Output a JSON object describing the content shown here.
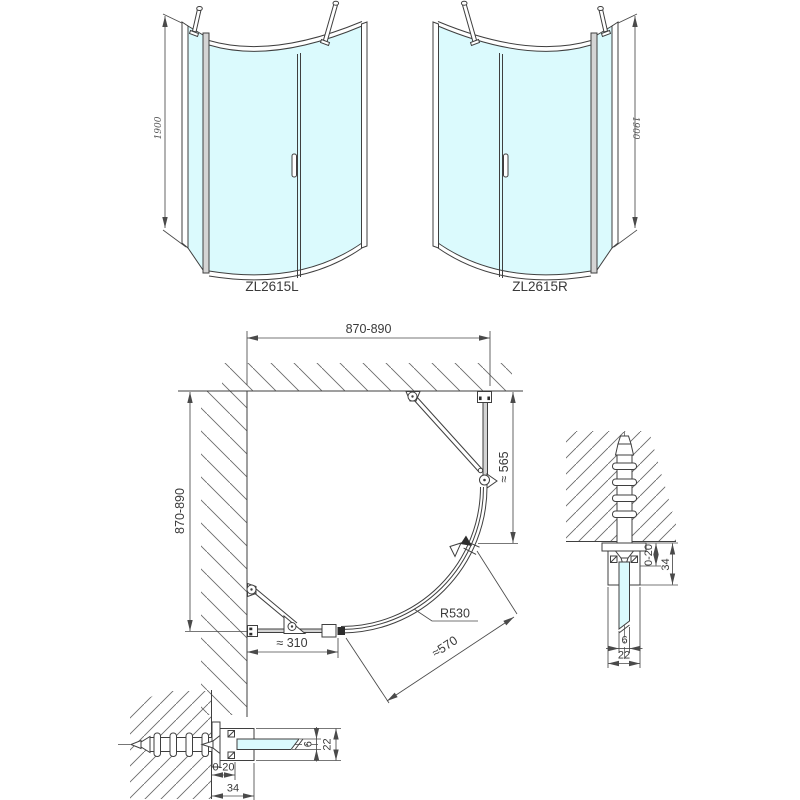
{
  "drawing": {
    "elevation_left": {
      "label": "ZL2615L",
      "height_dim": "1900"
    },
    "elevation_right": {
      "label": "ZL2615R",
      "height_dim": "1900"
    },
    "plan": {
      "width_dim": "870-890",
      "depth_dim": "870-890",
      "fixed_panel_dim": "≈ 565",
      "radius_dim": "R530",
      "entry_dim": "≈570",
      "side_panel_dim": "≈ 310"
    },
    "section_side": {
      "adjust_dim": "0-20",
      "depth_dim": "34",
      "glass_dim": "6",
      "width_dim": "22"
    },
    "section_bottom": {
      "adjust_dim": "0-20",
      "depth_dim": "34",
      "glass_dim": "6",
      "width_dim": "22"
    },
    "colors": {
      "glass": "#dbfafd",
      "line": "#3f3f3f",
      "dim": "#4a4a4a",
      "profile": "#d4d4d4"
    }
  }
}
